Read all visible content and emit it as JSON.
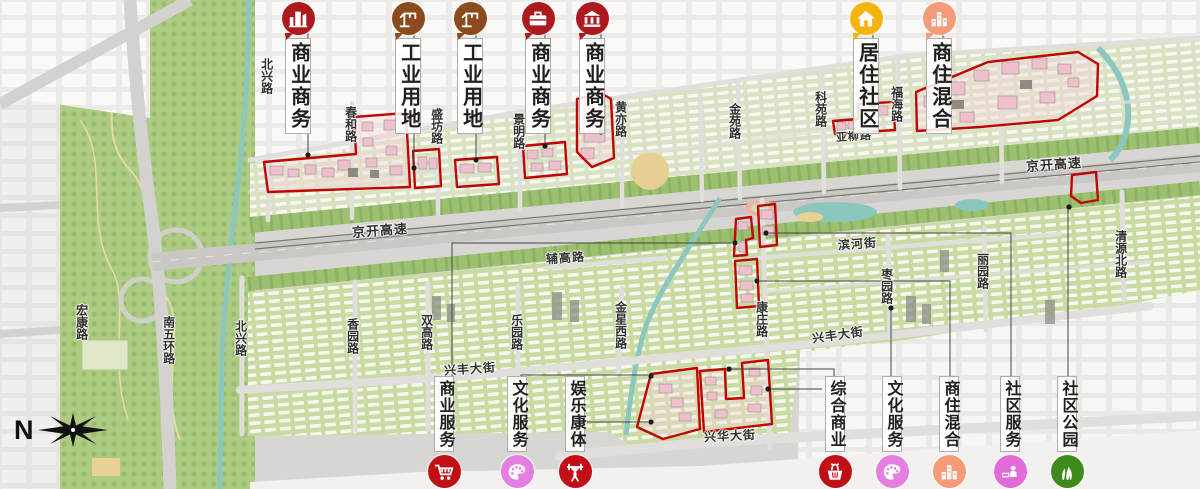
{
  "compass": {
    "north_label": "N"
  },
  "colors": {
    "zone_outline": "#c10505",
    "commercial_red": "#ac1a20",
    "industrial_brown": "#8c4a1f",
    "residential_yellow": "#f5b40d",
    "mixed_salmon": "#f49b77",
    "culture_pink": "#e57fdf",
    "service_magenta": "#e36bd9",
    "park_green": "#3e8a1c",
    "service_red": "#c20e15"
  },
  "legend_top": [
    {
      "label": "商业商务",
      "icon": "city-buildings-icon",
      "color": "#ac1a20"
    },
    {
      "label": "工业用地",
      "icon": "crane-icon",
      "color": "#8c4a1f"
    },
    {
      "label": "工业用地",
      "icon": "crane-icon",
      "color": "#8c4a1f"
    },
    {
      "label": "商业商务",
      "icon": "briefcase-icon",
      "color": "#ac1a20"
    },
    {
      "label": "商业商务",
      "icon": "bank-icon",
      "color": "#ac1a20"
    },
    {
      "label": "居住社区",
      "icon": "house-icon",
      "color": "#f5b40d"
    },
    {
      "label": "商住混合",
      "icon": "towers-icon",
      "color": "#f49b77"
    }
  ],
  "legend_bottom": [
    {
      "label": "商业服务",
      "icon": "shopping-cart-icon",
      "color": "#c20e15"
    },
    {
      "label": "文化服务",
      "icon": "palette-icon",
      "color": "#e57fdf"
    },
    {
      "label": "娱乐康体",
      "icon": "weightlifter-icon",
      "color": "#c20e15"
    },
    {
      "label": "综合商业",
      "icon": "basket-icon",
      "color": "#c20e15"
    },
    {
      "label": "文化服务",
      "icon": "palette-icon",
      "color": "#e57fdf"
    },
    {
      "label": "商住混合",
      "icon": "towers-icon",
      "color": "#f49b77"
    },
    {
      "label": "社区服务",
      "icon": "service-desk-icon",
      "color": "#e36bd9"
    },
    {
      "label": "社区公园",
      "icon": "grass-icon",
      "color": "#3e8a1c"
    }
  ],
  "roads": [
    {
      "label": "北兴路"
    },
    {
      "label": "春和路"
    },
    {
      "label": "盛坊路"
    },
    {
      "label": "景明路"
    },
    {
      "label": "黄亦路"
    },
    {
      "label": "金苑路"
    },
    {
      "label": "科苑路"
    },
    {
      "label": "福海路"
    },
    {
      "label": "亚柳路"
    },
    {
      "label": "京开高速"
    },
    {
      "label": "京开高速"
    },
    {
      "label": "辅高路"
    },
    {
      "label": "滨河街"
    },
    {
      "label": "清源北路"
    },
    {
      "label": "宏康路"
    },
    {
      "label": "南五环路"
    },
    {
      "label": "北兴路"
    },
    {
      "label": "香园路"
    },
    {
      "label": "双高路"
    },
    {
      "label": "乐园路"
    },
    {
      "label": "金星西路"
    },
    {
      "label": "康庄路"
    },
    {
      "label": "枣园路"
    },
    {
      "label": "丽园路"
    },
    {
      "label": "兴丰大街"
    },
    {
      "label": "兴丰大街"
    },
    {
      "label": "兴华大街"
    }
  ]
}
